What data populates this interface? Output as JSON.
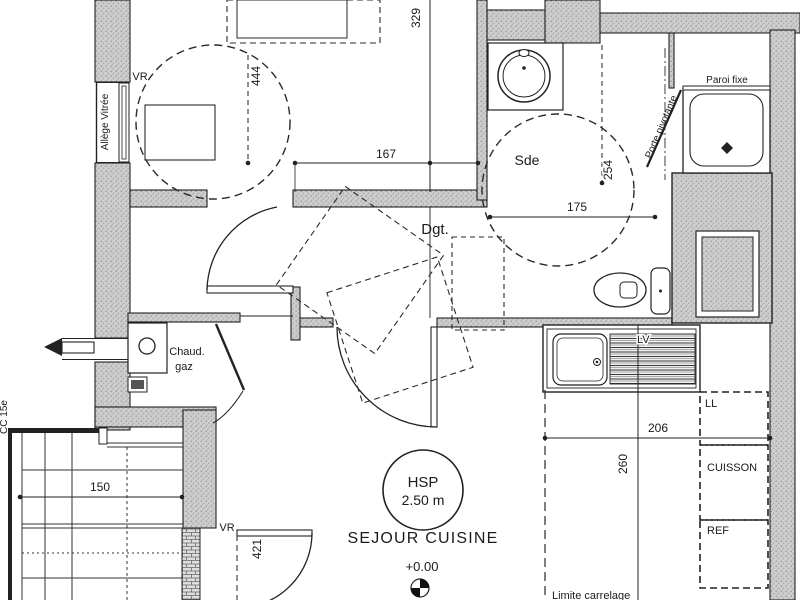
{
  "meta": {
    "drawing_type": "apartment floor plan",
    "colors": {
      "line": "#1f1f1f",
      "wall_fill": "#cdcdcd",
      "wall_speckle": "#8f8f8f",
      "background": "#ffffff"
    }
  },
  "rooms": {
    "sde": "Sde",
    "dgt": "Dgt.",
    "sejour": "SEJOUR CUISINE"
  },
  "ceiling": {
    "tag": "HSP",
    "value": "2.50 m"
  },
  "level": "+0.00",
  "boiler": {
    "line1": "Chaud.",
    "line2": "gaz"
  },
  "shower": {
    "fixed_panel": "Paroi fixe",
    "pivot_door": "Porte pivotante"
  },
  "appliances": {
    "sink_unit": "LV",
    "washer": "LL",
    "cooking": "CUISSON",
    "fridge": "REF"
  },
  "notes": {
    "tile_limit": "Limite carrelage",
    "sill": "Allège Vitrée",
    "vr_top": "VR",
    "vr_bottom": "VR",
    "edge": "CC 15e"
  },
  "dims": {
    "w329": "329",
    "w444": "444",
    "w167": "167",
    "w254": "254",
    "w175": "175",
    "w206": "206",
    "w260": "260",
    "w150": "150",
    "w421": "421"
  }
}
